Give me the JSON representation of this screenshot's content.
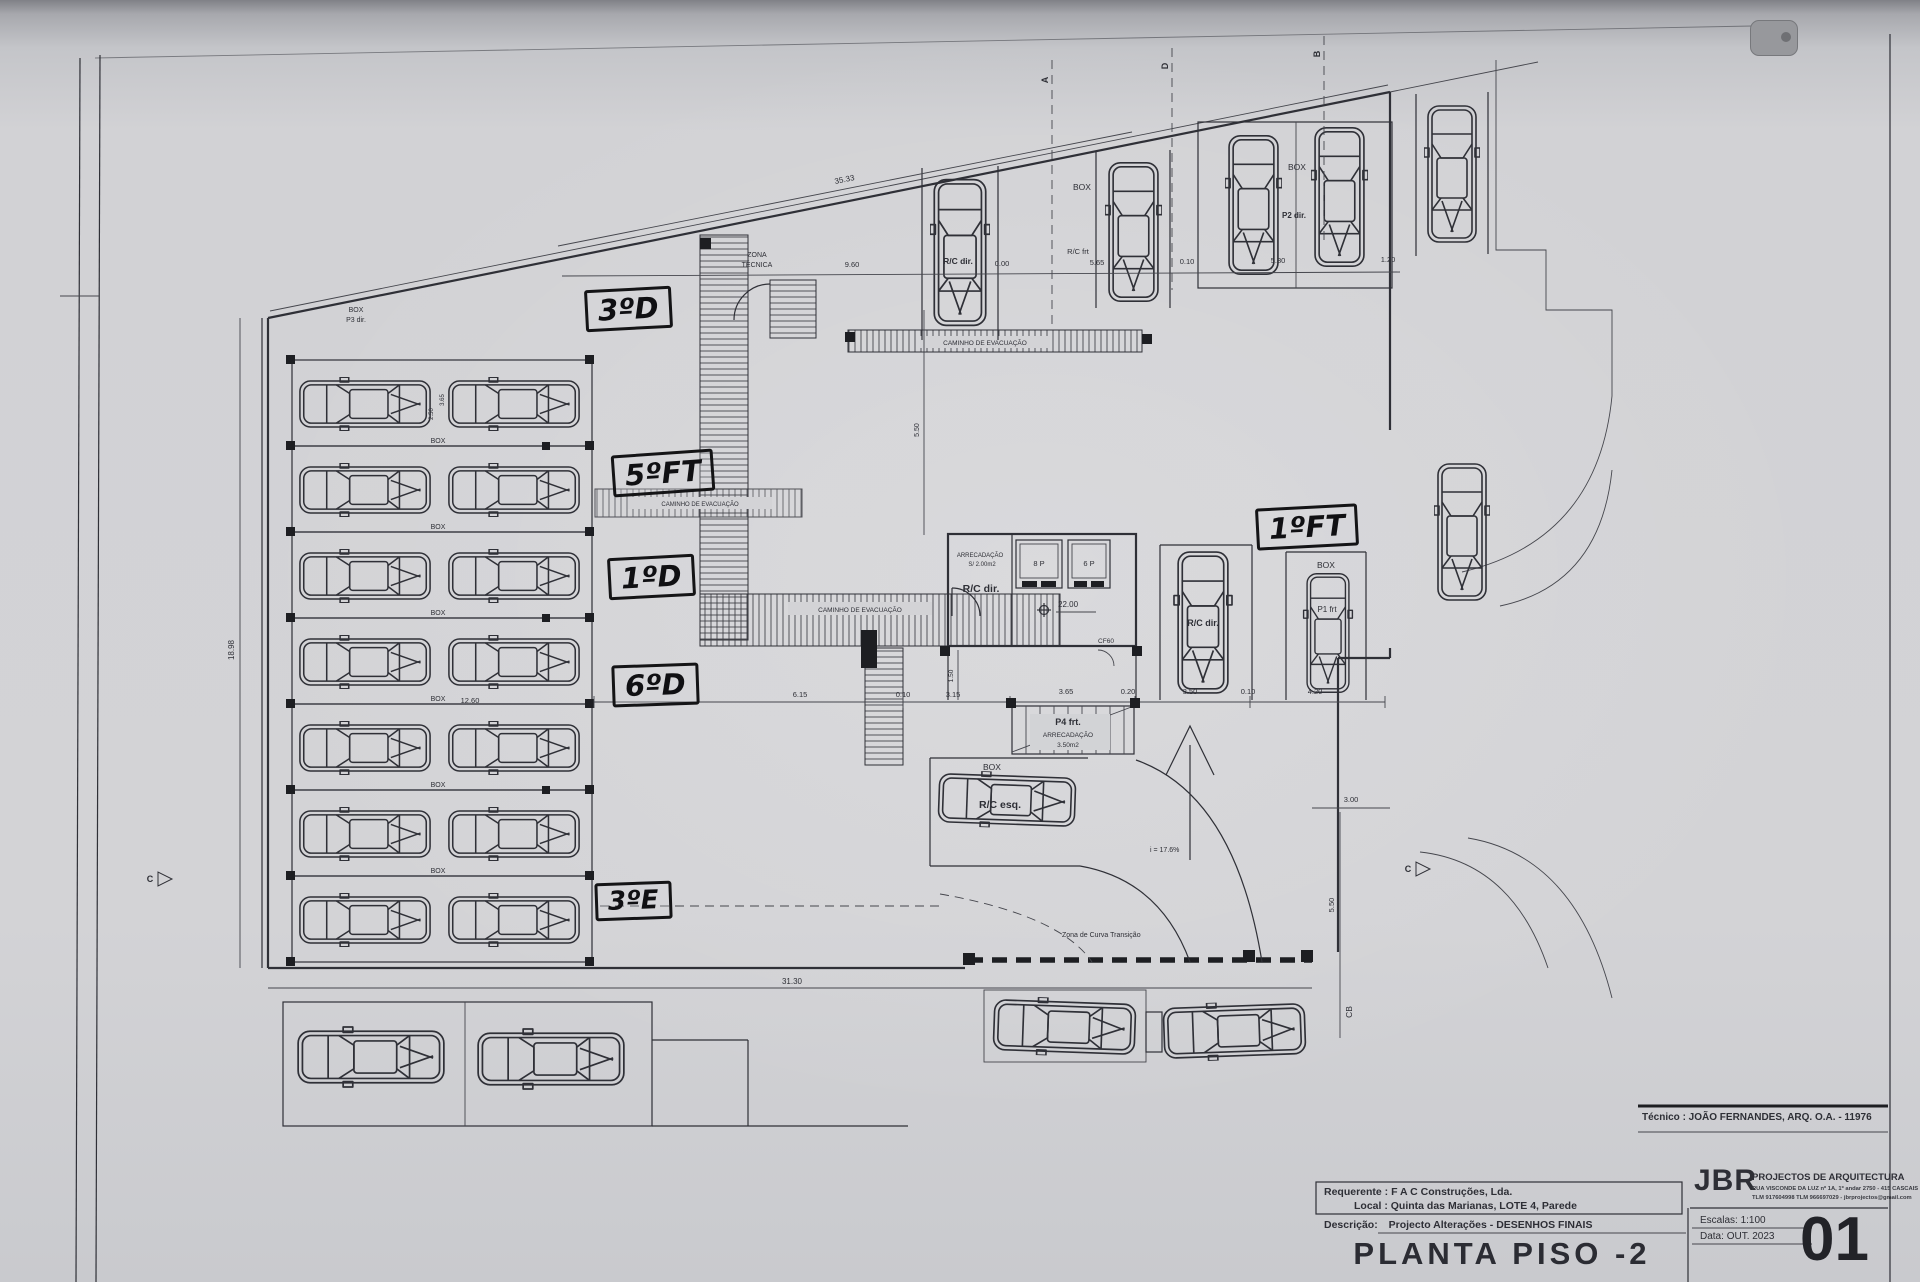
{
  "colors": {
    "paper": "#d2d2d5",
    "ink": "#2f3037",
    "marker": "#131316"
  },
  "title_block": {
    "tecnico": "Técnico : JOÃO FERNANDES, ARQ.  O.A. - 11976",
    "requerente_label": "Requerente :",
    "requerente_value": "F A C  Construções, Lda.",
    "local_label": "Local :",
    "local_value": "Quinta das Marianas, LOTE 4, Parede",
    "descricao_label": "Descrição:",
    "descricao_value": "Projecto Alterações - DESENHOS FINAIS",
    "drawing_title": "PLANTA PISO -2",
    "firm_initials": "JBR",
    "firm_name": "PROJECTOS DE ARQUITECTURA",
    "firm_address": "RUA VISCONDE DA LUZ nº 1A, 1º andar  2750 - 415  CASCAIS",
    "firm_contacts": "TLM 917604998  TLM 966697029 - jbrprojectos@gmail.com",
    "escala_label": "Escalas:",
    "escala_value": "1:100",
    "data_label": "Data:",
    "data_value": "OUT. 2023",
    "sheet_number": "01"
  },
  "handwritten": {
    "h_3d": "3ºD",
    "h_5ft": "5ºFT",
    "h_1d": "1ºD",
    "h_6d": "6ºD",
    "h_3e": "3ºE",
    "h_1ft": "1ºFT"
  },
  "labels": {
    "box": "BOX",
    "zona_1": "ZONA",
    "zona_2": "TÉCNICA",
    "caminho": "CAMINHO DE EVACUAÇÃO",
    "arrecadacao": "ARRECADAÇÃO",
    "arrec_area_small": "S/ 2.00m2",
    "arrec_area_stair": "3.50m2",
    "rc_dir": "R/C dir.",
    "rc_esq": "R/C esq.",
    "rc_frt": "R/C frt",
    "p1_frt": "P1 frt",
    "p2_dir": "P2 dir.",
    "p3_dir": "P3 dir.",
    "p4_frt": "P4 frt.",
    "lift_8p": "8 P",
    "lift_6p": "6 P",
    "level": "22.00",
    "cf60": "CF60",
    "slope": "i = 17.6%",
    "zona_curva": "Zona de Curva Transição"
  },
  "dims": {
    "d35_33": "35.33",
    "d31_30": "31.30",
    "d18_98": "18.98",
    "d12_60": "12.60",
    "d9_60": "9.60",
    "d0_00": "0.00",
    "d5_65": "5.65",
    "d0_10": "0.10",
    "d5_80": "5.80",
    "d1_20": "1.20",
    "d6_15": "6.15",
    "d3_15": "3.15",
    "d3_65": "3.65",
    "d0_20": "0.20",
    "d3_50": "3.50",
    "d4_20": "4.20",
    "d3_00": "3.00",
    "d5_50": "5.50",
    "d1_50": "1.50",
    "d2_50": "2.50"
  },
  "markers": {
    "a": "A",
    "b": "B",
    "d": "D",
    "c": "C",
    "cb": "CB"
  }
}
